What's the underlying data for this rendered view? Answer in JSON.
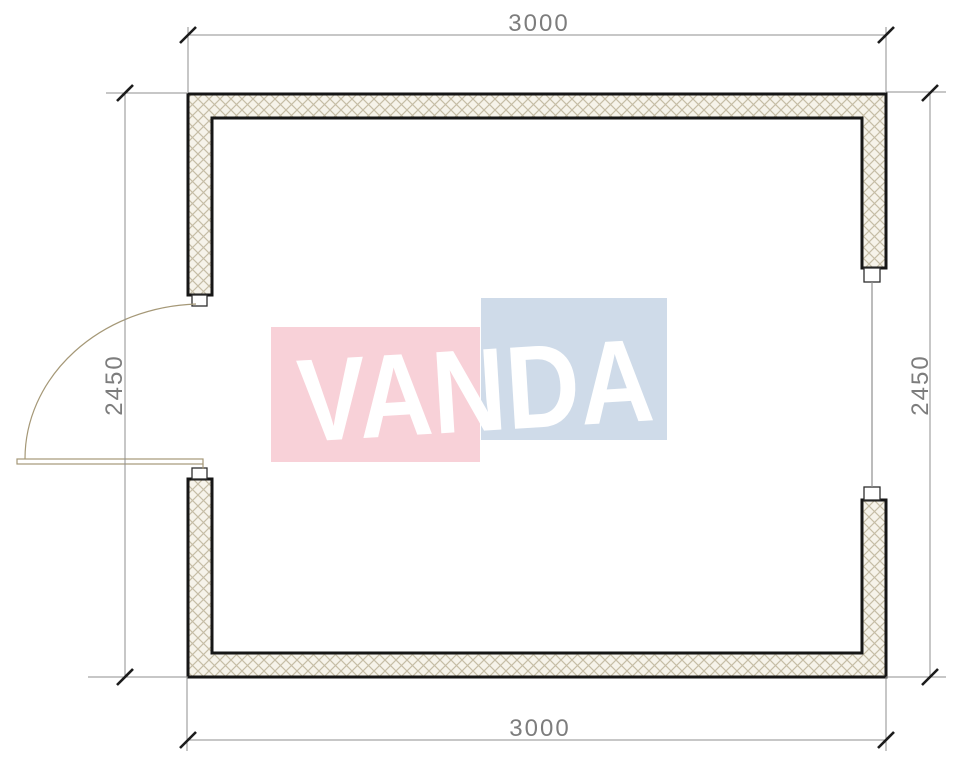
{
  "dimensions": {
    "top": "3000",
    "bottom": "3000",
    "left": "2450",
    "right": "2450"
  },
  "watermark": {
    "text": "VANDA"
  },
  "colors": {
    "wall_outline": "#161616",
    "wall_fill": "#f6f3ea",
    "hatch_line": "#c6bda6",
    "dim_line": "#8f8f8f",
    "dim_text": "#7d7d7d",
    "tick": "#1c1c1c",
    "door_line": "#a59877",
    "door_leaf_fill": "#fdfbec",
    "window_line": "#8f8f8f",
    "logo_pink": "#f8d1d8",
    "logo_blue": "#cfdbe9",
    "logo_text": "#ffffff"
  }
}
